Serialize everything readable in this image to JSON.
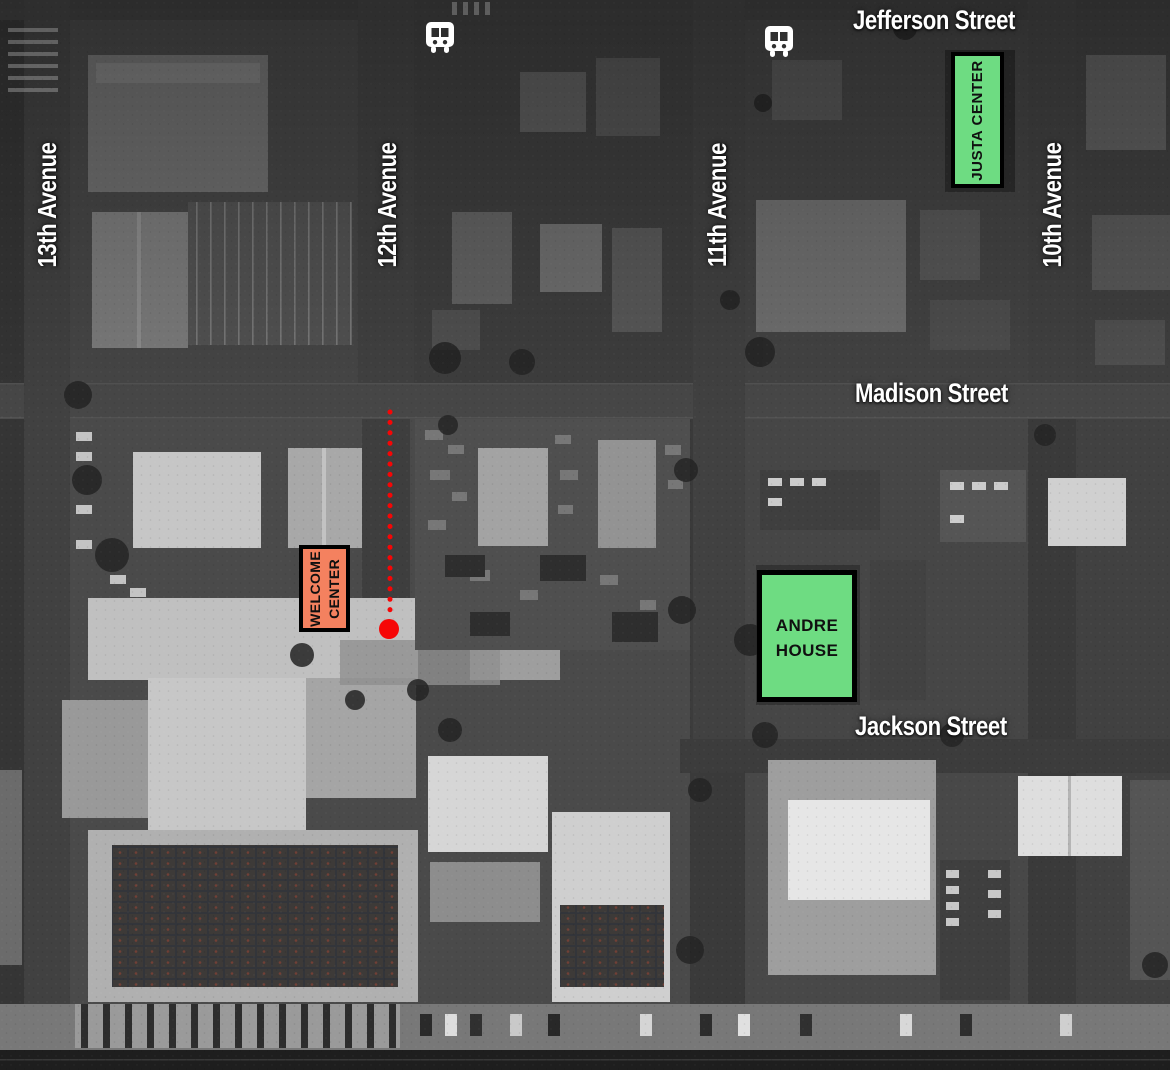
{
  "map": {
    "streets": {
      "jefferson": "Jefferson Street",
      "madison": "Madison Street",
      "jackson": "Jackson Street"
    },
    "avenues": {
      "a13": "13th Avenue",
      "a12": "12th Avenue",
      "a11": "11th Avenue",
      "a10": "10th Avenue"
    },
    "places": {
      "justa_center": "JUSTA CENTER",
      "welcome_center_line1": "WELCOME",
      "welcome_center_line2": "CENTER",
      "andre_house_line1": "ANDRE",
      "andre_house_line2": "HOUSE"
    },
    "icons": {
      "bus_stop_north_12th": "bus-icon",
      "bus_stop_north_11th": "bus-icon"
    },
    "colors": {
      "highlight_green": "#6edc82",
      "highlight_salmon": "#f4815f",
      "route_red": "#f60606",
      "box_border": "#000000",
      "label_white": "#ffffff"
    }
  }
}
